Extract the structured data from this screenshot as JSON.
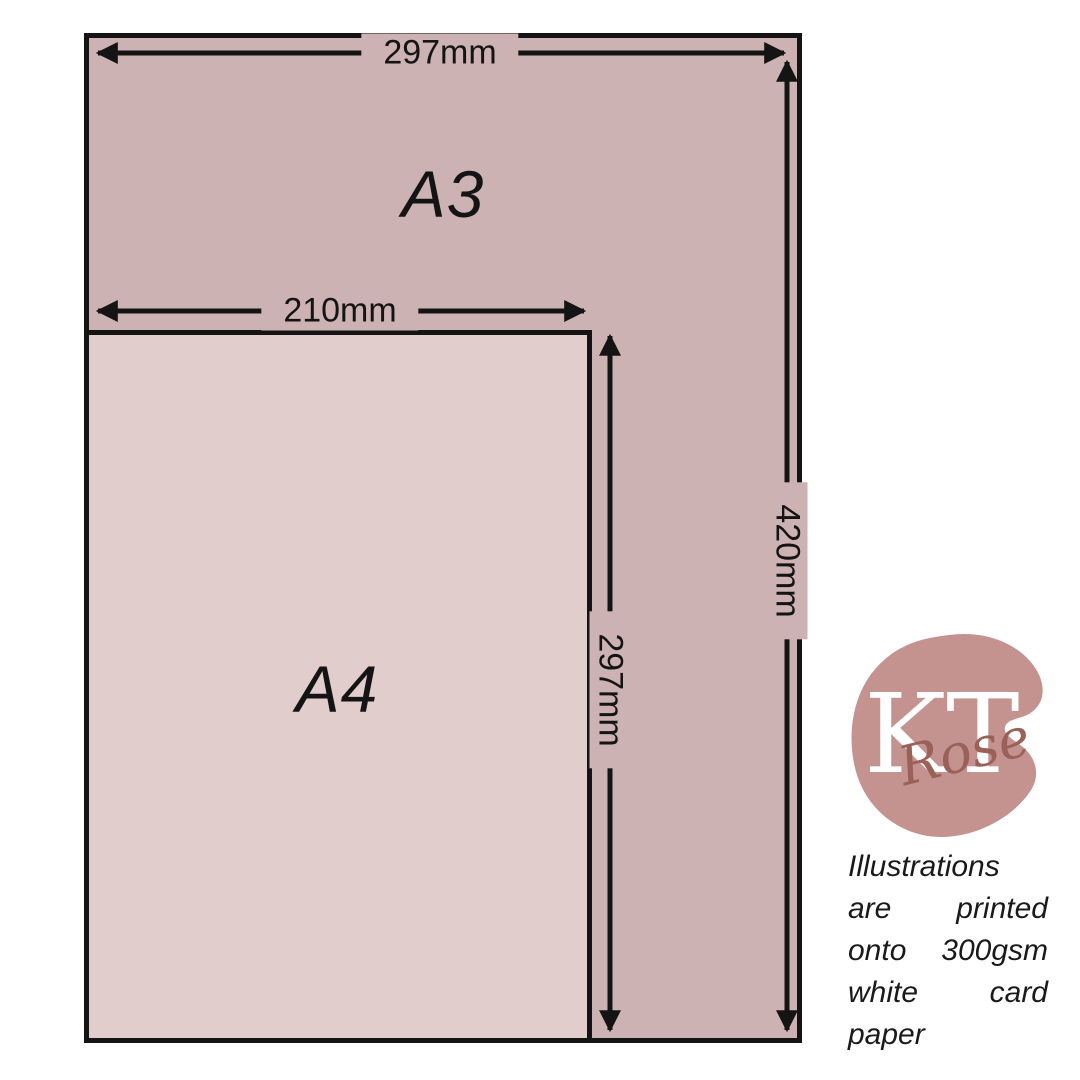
{
  "page": {
    "background_color": "#ffffff"
  },
  "diagram": {
    "border_color": "#141414",
    "arrow_color": "#141414",
    "a3": {
      "label": "A3",
      "fill": "#ccb2b2",
      "width_label": "297mm",
      "height_label": "420mm"
    },
    "a4": {
      "label": "A4",
      "fill": "#e1cdcc",
      "width_label": "210mm",
      "height_label": "297mm"
    }
  },
  "logo": {
    "monogram": "KT",
    "script": "Rose",
    "blob_color": "#c49390",
    "monogram_color": "#ffffff",
    "script_color": "#9a6158"
  },
  "footer_note": {
    "text": "Illustrations are printed onto 300gsm white card paper",
    "color": "#1a1a1a"
  }
}
